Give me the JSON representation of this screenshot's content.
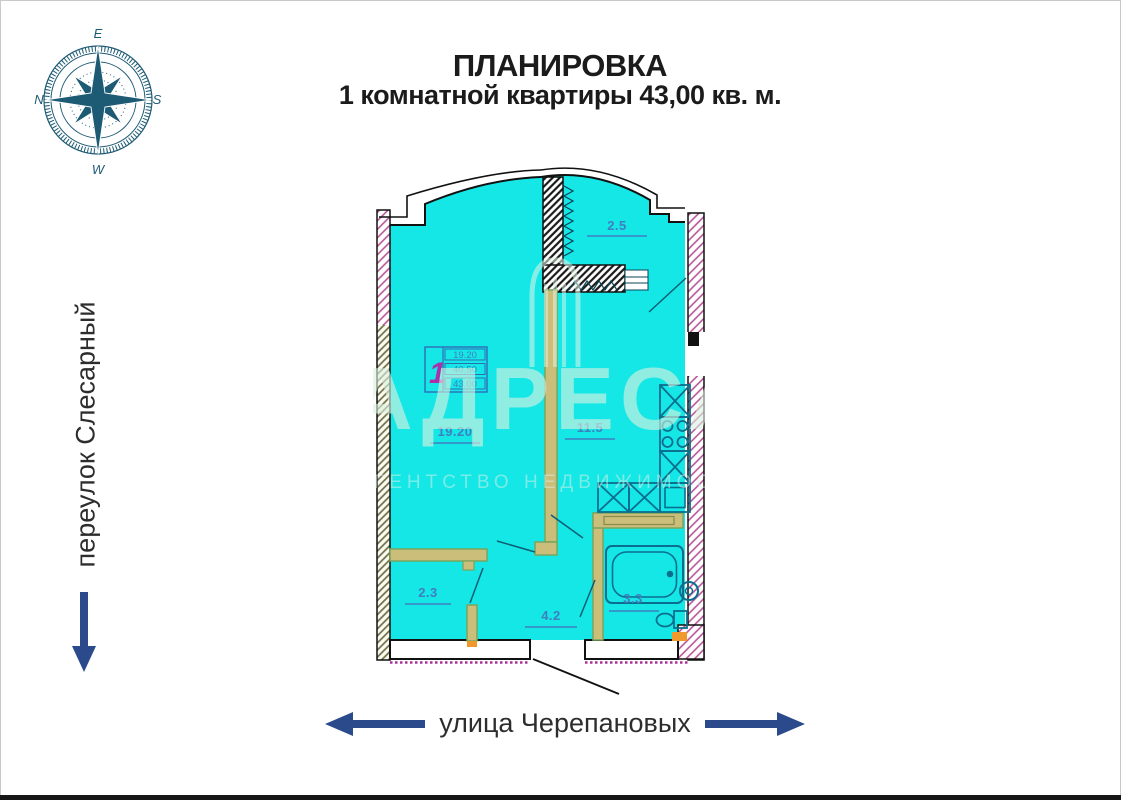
{
  "page": {
    "title_line1": "ПЛАНИРОВКА",
    "title_line2": "1 комнатной квартиры 43,00 кв. м."
  },
  "streets": {
    "left": "переулок Слесарный",
    "bottom": "улица Черепановых"
  },
  "compass": {
    "east": "E",
    "south": "S",
    "west": "W",
    "north": "N"
  },
  "plan": {
    "rooms": [
      {
        "name": "balcony",
        "area_label": "2.5"
      },
      {
        "name": "living-room",
        "area_label": "19.20"
      },
      {
        "name": "kitchen",
        "area_label": "11.5"
      },
      {
        "name": "closet",
        "area_label": "2.3"
      },
      {
        "name": "hallway",
        "area_label": "4.2"
      },
      {
        "name": "bathroom",
        "area_label": "3.3"
      }
    ],
    "info_table": {
      "rooms_count": "1",
      "living_area": "19.20",
      "area_without_balcony": "40.50",
      "total_area": "43.00"
    }
  },
  "watermark": {
    "brand": "АДРЕСА",
    "subtitle": "агентство недвижимости"
  },
  "colors": {
    "plan_fill": "#14e7e6",
    "label_blue": "#3f7fbf",
    "arrow_blue": "#2a4a8c",
    "wall_tan": "#cbbd7a",
    "wall_olive_border": "#7aa45c",
    "hatch_pink": "#b44a92",
    "hatch_olive": "#6e6e45",
    "fixture_teal": "#0c6e8e",
    "compass_blue": "#1d5a74",
    "accent_orange": "#f09a2e",
    "table_magenta": "#a832aa",
    "table_blue": "#2f6db5"
  }
}
